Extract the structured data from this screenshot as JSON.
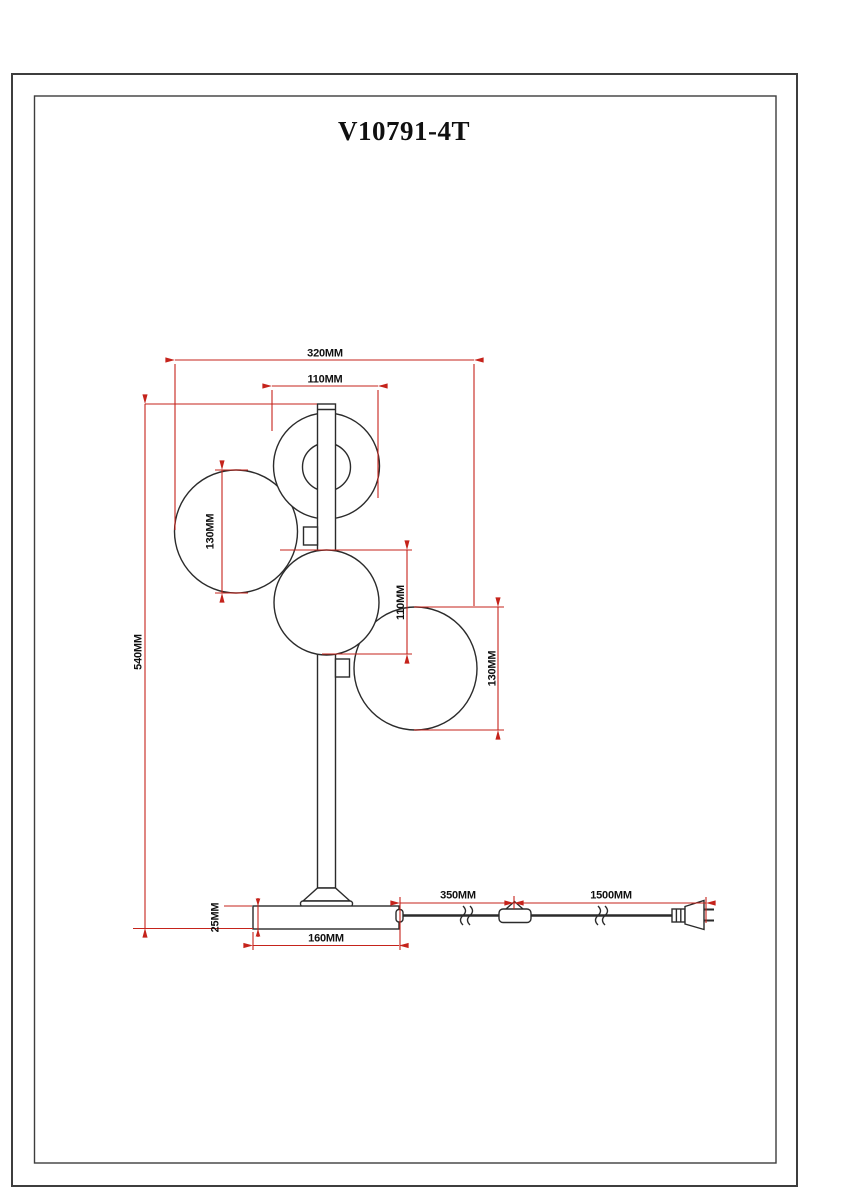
{
  "page": {
    "title": "V10791-4T",
    "background": "#ffffff"
  },
  "drawing": {
    "kind": "technical dimension drawing",
    "subject": "table lamp with four glass globes, round base, inline cord switch and power plug",
    "colors": {
      "outline": "#2b2b2b",
      "dimension_lines": "#c5231b",
      "frame": "#3d3d3d"
    },
    "dimensions": {
      "total_width": "320MM",
      "top_globe_diameter": "110MM",
      "left_globe_diameter": "130MM",
      "middle_globe_diameter": "110MM",
      "right_globe_diameter": "130MM",
      "total_height": "540MM",
      "base_thickness": "25MM",
      "base_width": "160MM",
      "cord_base_to_switch": "350MM",
      "cord_switch_to_plug": "1500MM"
    }
  }
}
